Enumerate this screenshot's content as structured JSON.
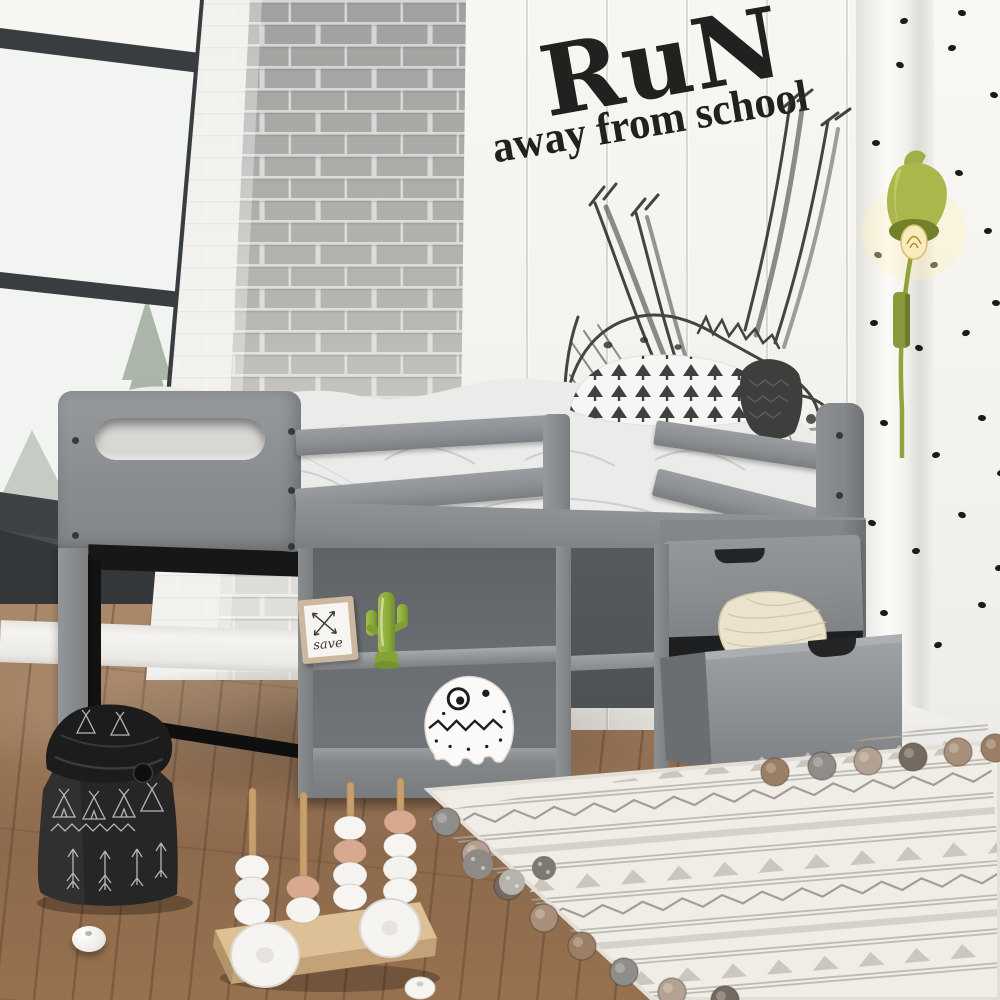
{
  "wall_decal": {
    "line1": "RuN",
    "line2": "away from school"
  },
  "shelf_frame": {
    "text": "save"
  },
  "palette": {
    "bed_gray": "#8a8d90",
    "lamp_green": "#9aae3c",
    "cactus_green": "#8fae3e",
    "wall_white": "#f4f3f0",
    "brick_gray": "#a8a6a4",
    "floor_brown": "#96755a",
    "rug_cream": "#f0ede6",
    "decal_black": "#23211f",
    "dot_black": "#1a1a1a",
    "bag_black": "#232323",
    "toy_wood": "#d9bc92",
    "bead_pink": "#d9a98f"
  }
}
